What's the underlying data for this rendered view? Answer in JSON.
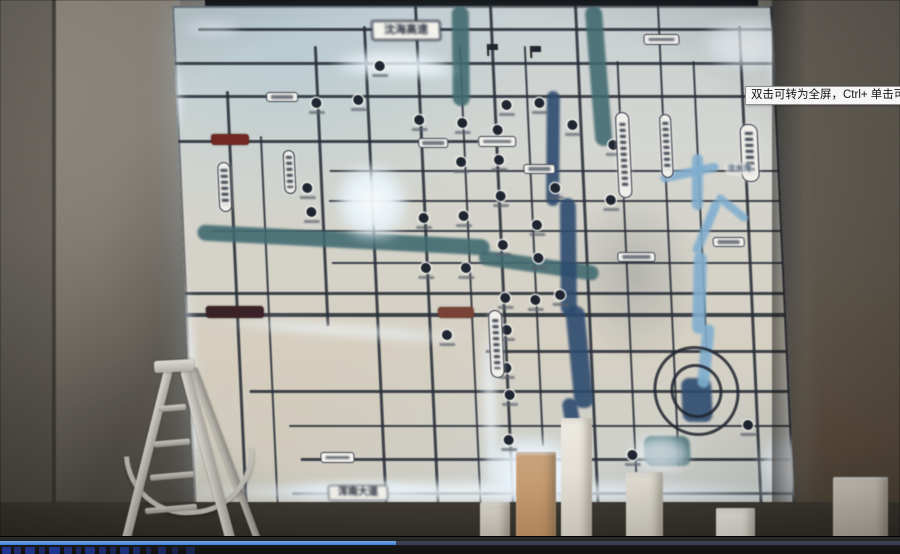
{
  "player": {
    "tooltip_text": "双击可转为全屏，Ctrl+ 单击可转为",
    "progress_fraction": 0.44,
    "progress_color": "#3d7dd2",
    "track_color": "#39414e",
    "watermark_marks": [
      [
        2,
        9,
        0.9
      ],
      [
        14,
        7,
        0.7
      ],
      [
        25,
        10,
        0.85
      ],
      [
        39,
        6,
        0.6
      ],
      [
        49,
        11,
        0.9
      ],
      [
        64,
        8,
        0.7
      ],
      [
        76,
        5,
        0.55
      ],
      [
        85,
        10,
        0.8
      ],
      [
        99,
        7,
        0.65
      ],
      [
        110,
        6,
        0.5
      ],
      [
        120,
        9,
        0.75
      ],
      [
        133,
        7,
        0.6
      ],
      [
        146,
        5,
        0.45
      ],
      [
        158,
        8,
        0.55
      ],
      [
        172,
        6,
        0.4
      ],
      [
        186,
        9,
        0.45
      ]
    ]
  },
  "palette": {
    "road": "#262c38",
    "river_teal": "#3e6b72",
    "river_blue": "#2a4a72",
    "river_light": "#7db0d4",
    "glow": "#eaf6ff",
    "map_background": "#d6d8d2",
    "wall": "#6e6860"
  },
  "map": {
    "labels": {
      "highway_top": "沈海高速",
      "avenue_bottom": "浑南大道",
      "lake": "沈水湾"
    },
    "geometry": {
      "h_roads": [
        [
          22,
          25,
          600,
          3
        ],
        [
          56,
          0,
          600,
          2.5
        ],
        [
          89,
          0,
          600,
          2.5
        ],
        [
          134,
          0,
          300,
          3
        ],
        [
          164,
          150,
          600,
          2
        ],
        [
          194,
          148,
          600,
          2
        ],
        [
          224,
          30,
          600,
          2
        ],
        [
          256,
          148,
          600,
          2
        ],
        [
          286,
          0,
          600,
          2.5
        ],
        [
          307,
          0,
          600,
          3.5
        ],
        [
          344,
          298,
          600,
          2.5
        ],
        [
          384,
          60,
          600,
          2.5
        ],
        [
          419,
          98,
          600,
          2
        ],
        [
          452,
          108,
          600,
          2.5
        ],
        [
          486,
          98,
          600,
          3
        ]
      ],
      "v_roads": [
        [
          50,
          85,
          499,
          2.5
        ],
        [
          82,
          130,
          499,
          2
        ],
        [
          140,
          40,
          320,
          2.5
        ],
        [
          190,
          20,
          499,
          2.5
        ],
        [
          242,
          0,
          499,
          2.5
        ],
        [
          285,
          40,
          499,
          2
        ],
        [
          317,
          0,
          499,
          2.5
        ],
        [
          350,
          40,
          440,
          2
        ],
        [
          402,
          0,
          499,
          2.5
        ],
        [
          442,
          55,
          499,
          2
        ],
        [
          485,
          0,
          460,
          2
        ],
        [
          518,
          55,
          345,
          2
        ],
        [
          565,
          20,
          499,
          2.5
        ],
        [
          598,
          0,
          499,
          3
        ]
      ],
      "rivers": [
        [
          278,
          0,
          17,
          100,
          2,
          "teal"
        ],
        [
          415,
          0,
          17,
          140,
          -2,
          "teal"
        ],
        [
          15,
          226,
          292,
          16,
          3,
          "teal"
        ],
        [
          295,
          252,
          120,
          15,
          8,
          "teal"
        ],
        [
          452,
          430,
          46,
          30,
          0,
          "teal"
        ],
        [
          368,
          85,
          13,
          115,
          3,
          "blue"
        ],
        [
          377,
          192,
          16,
          118,
          2,
          "blue"
        ],
        [
          382,
          300,
          19,
          102,
          -3,
          "blue"
        ],
        [
          375,
          392,
          15,
          62,
          -7,
          "blue"
        ],
        [
          492,
          372,
          30,
          44,
          0,
          "blue"
        ],
        [
          480,
          162,
          60,
          9,
          -12,
          "light"
        ],
        [
          512,
          148,
          11,
          56,
          3,
          "light"
        ],
        [
          520,
          192,
          9,
          58,
          25,
          "light"
        ],
        [
          532,
          198,
          38,
          8,
          40,
          "light"
        ],
        [
          508,
          246,
          13,
          82,
          4,
          "light"
        ],
        [
          512,
          318,
          12,
          64,
          8,
          "light"
        ]
      ],
      "glows": [
        [
          155,
          158,
          72,
          76,
          0.95,
          0
        ],
        [
          0,
          476,
          600,
          20,
          0.85,
          0
        ],
        [
          88,
          478,
          150,
          14,
          0.9,
          0
        ],
        [
          290,
          430,
          100,
          70,
          0.9,
          0
        ],
        [
          566,
          430,
          54,
          62,
          0.85,
          0
        ],
        [
          -6,
          278,
          12,
          200,
          0.9,
          0
        ],
        [
          -6,
          50,
          10,
          75,
          0.8,
          0
        ],
        [
          160,
          45,
          110,
          26,
          0.8,
          0
        ],
        [
          530,
          12,
          92,
          52,
          0.75,
          0
        ],
        [
          596,
          22,
          14,
          75,
          0.8,
          0
        ],
        [
          294,
          322,
          12,
          155,
          0.85,
          0
        ],
        [
          438,
          428,
          60,
          40,
          0.7,
          0
        ],
        [
          40,
          320,
          240,
          9,
          0.9,
          4
        ],
        [
          222,
          56,
          60,
          14,
          0.7,
          2
        ],
        [
          8,
          14,
          60,
          16,
          0.5,
          0
        ]
      ],
      "rings": [
        [
          504,
          382,
          40
        ],
        [
          504,
          382,
          23
        ]
      ],
      "markers": [
        [
          140,
          97
        ],
        [
          182,
          94
        ],
        [
          205,
          60
        ],
        [
          242,
          114
        ],
        [
          285,
          117
        ],
        [
          320,
          124
        ],
        [
          330,
          99
        ],
        [
          363,
          97
        ],
        [
          282,
          156
        ],
        [
          320,
          154
        ],
        [
          375,
          182
        ],
        [
          320,
          190
        ],
        [
          282,
          210
        ],
        [
          242,
          212
        ],
        [
          127,
          182
        ],
        [
          130,
          206
        ],
        [
          355,
          219
        ],
        [
          320,
          239
        ],
        [
          282,
          262
        ],
        [
          242,
          262
        ],
        [
          355,
          252
        ],
        [
          320,
          292
        ],
        [
          375,
          289
        ],
        [
          260,
          329
        ],
        [
          320,
          324
        ],
        [
          435,
          139
        ],
        [
          430,
          194
        ],
        [
          395,
          119
        ],
        [
          440,
          449
        ],
        [
          557,
          419
        ],
        [
          318,
          362
        ],
        [
          320,
          389
        ],
        [
          317,
          434
        ],
        [
          350,
          294
        ]
      ],
      "capsules": [
        [
          38,
          156,
          11,
          48
        ],
        [
          104,
          144,
          10,
          42
        ],
        [
          438,
          106,
          12,
          84
        ],
        [
          482,
          108,
          10,
          62
        ],
        [
          562,
          118,
          16,
          56
        ],
        [
          302,
          304,
          12,
          66
        ]
      ],
      "small_labels": [
        [
          128,
          446,
          32,
          9
        ],
        [
          300,
          130,
          36,
          9
        ],
        [
          344,
          158,
          30,
          8
        ],
        [
          434,
          246,
          36,
          8
        ],
        [
          530,
          231,
          30,
          8
        ],
        [
          240,
          132,
          28,
          8
        ],
        [
          470,
          28,
          34,
          9
        ],
        [
          90,
          86,
          30,
          8
        ]
      ],
      "red_labels": [
        [
          33,
          128,
          38,
          11,
          "#76241e"
        ],
        [
          20,
          300,
          58,
          12,
          "#3a2024"
        ],
        [
          252,
          301,
          36,
          11,
          "#7d4032"
        ]
      ],
      "flags": [
        [
          313,
          38
        ],
        [
          356,
          40
        ]
      ]
    }
  },
  "foreground": {
    "pillars": [
      [
        480,
        502,
        30,
        52,
        "#dcd7cb",
        "#b9b2a4"
      ],
      [
        516,
        452,
        40,
        102,
        "#cfa478",
        "#c08b58"
      ],
      [
        561,
        418,
        31,
        136,
        "#f1ede4",
        "#d9d3c6"
      ],
      [
        626,
        472,
        37,
        82,
        "#eae6db",
        "#cfc9bb"
      ],
      [
        716,
        508,
        39,
        46,
        "#f0ede5",
        "#d8d4c8"
      ],
      [
        833,
        477,
        55,
        77,
        "#dcd7cb",
        "#b3ab9a"
      ]
    ]
  }
}
